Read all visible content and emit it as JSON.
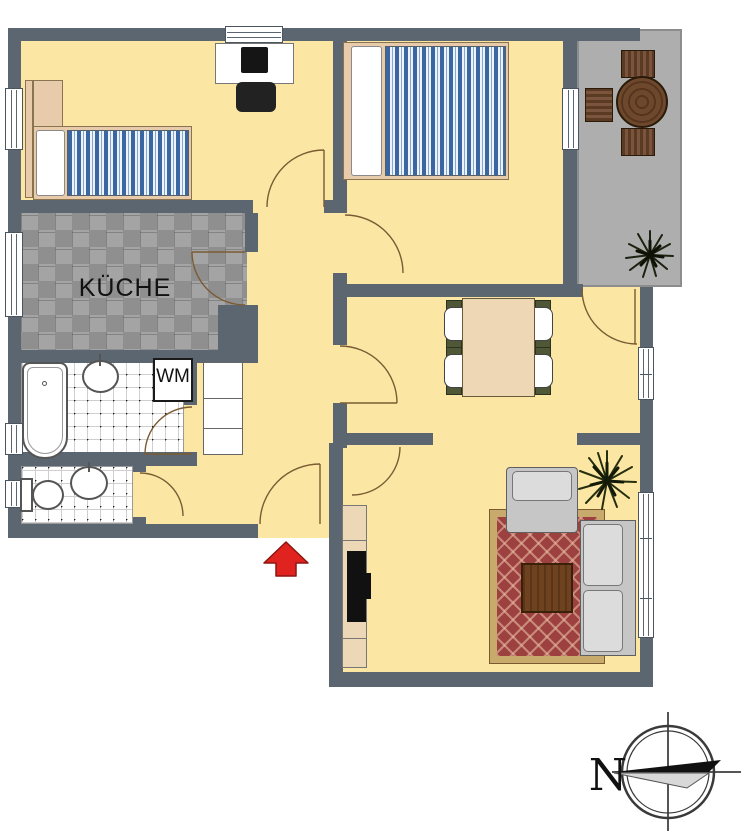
{
  "labels": {
    "kitchen": "KÜCHE",
    "washing_machine": "WM",
    "compass_north": "N"
  },
  "colors": {
    "wall": "#5b6670",
    "floor": "#fbe7a3",
    "balcony": "#aeaeae",
    "tileA": "#8f8f8f",
    "tileB": "#a4a4a4",
    "mattress": "#3a67a1",
    "rug": "#9c4040",
    "rugBorder": "#c9aa6d",
    "arrow": "#e0231e",
    "arrowEdge": "#8c1510",
    "arc": "#7b5b33",
    "wood": "#e8cbaa"
  }
}
